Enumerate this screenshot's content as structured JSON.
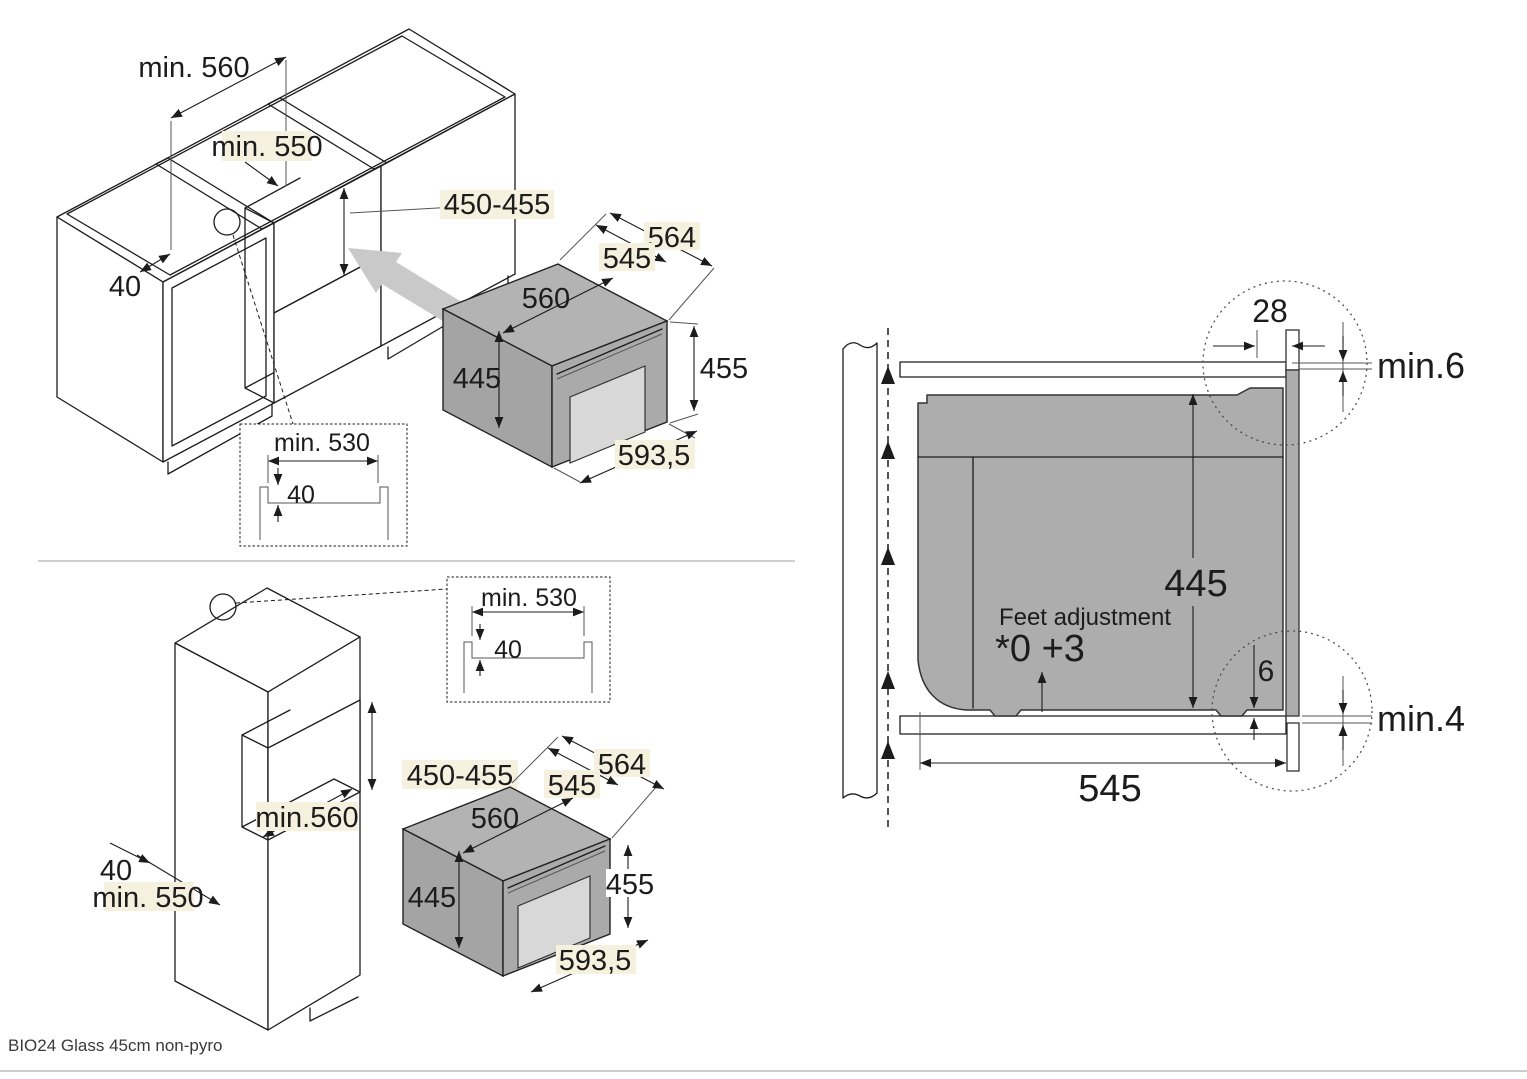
{
  "top_left": {
    "dims": {
      "width": "min. 560",
      "inner": "min. 550",
      "niche_height": "450-455",
      "rail": "40"
    },
    "inset": {
      "width": "min. 530",
      "depth": "40"
    },
    "oven": {
      "depth_total": "564",
      "depth_body": "545",
      "width": "560",
      "height_body": "445",
      "height_front": "455",
      "width_front": "593,5"
    }
  },
  "bottom_left": {
    "dims": {
      "niche_height": "450-455",
      "niche_width": "min.560",
      "rail": "40",
      "inner": "min. 550"
    },
    "inset": {
      "width": "min. 530",
      "depth": "40"
    },
    "oven": {
      "depth_total": "564",
      "depth_body": "545",
      "width": "560",
      "height_body": "445",
      "height_front": "455",
      "width_front": "593,5"
    }
  },
  "right": {
    "top_gap": "28",
    "top_clearance": "min.6",
    "height": "445",
    "feet_label": "Feet adjustment",
    "feet_values": "*0 +3",
    "foot_height": "6",
    "bottom_clearance": "min.4",
    "depth": "545"
  },
  "footer": {
    "model": "BIO24 Glass 45cm non-pyro"
  },
  "colors": {
    "oven_gray": "#a8a8a8",
    "arrow_gray": "#c9c9c9",
    "highlight": "#f6f0df"
  }
}
